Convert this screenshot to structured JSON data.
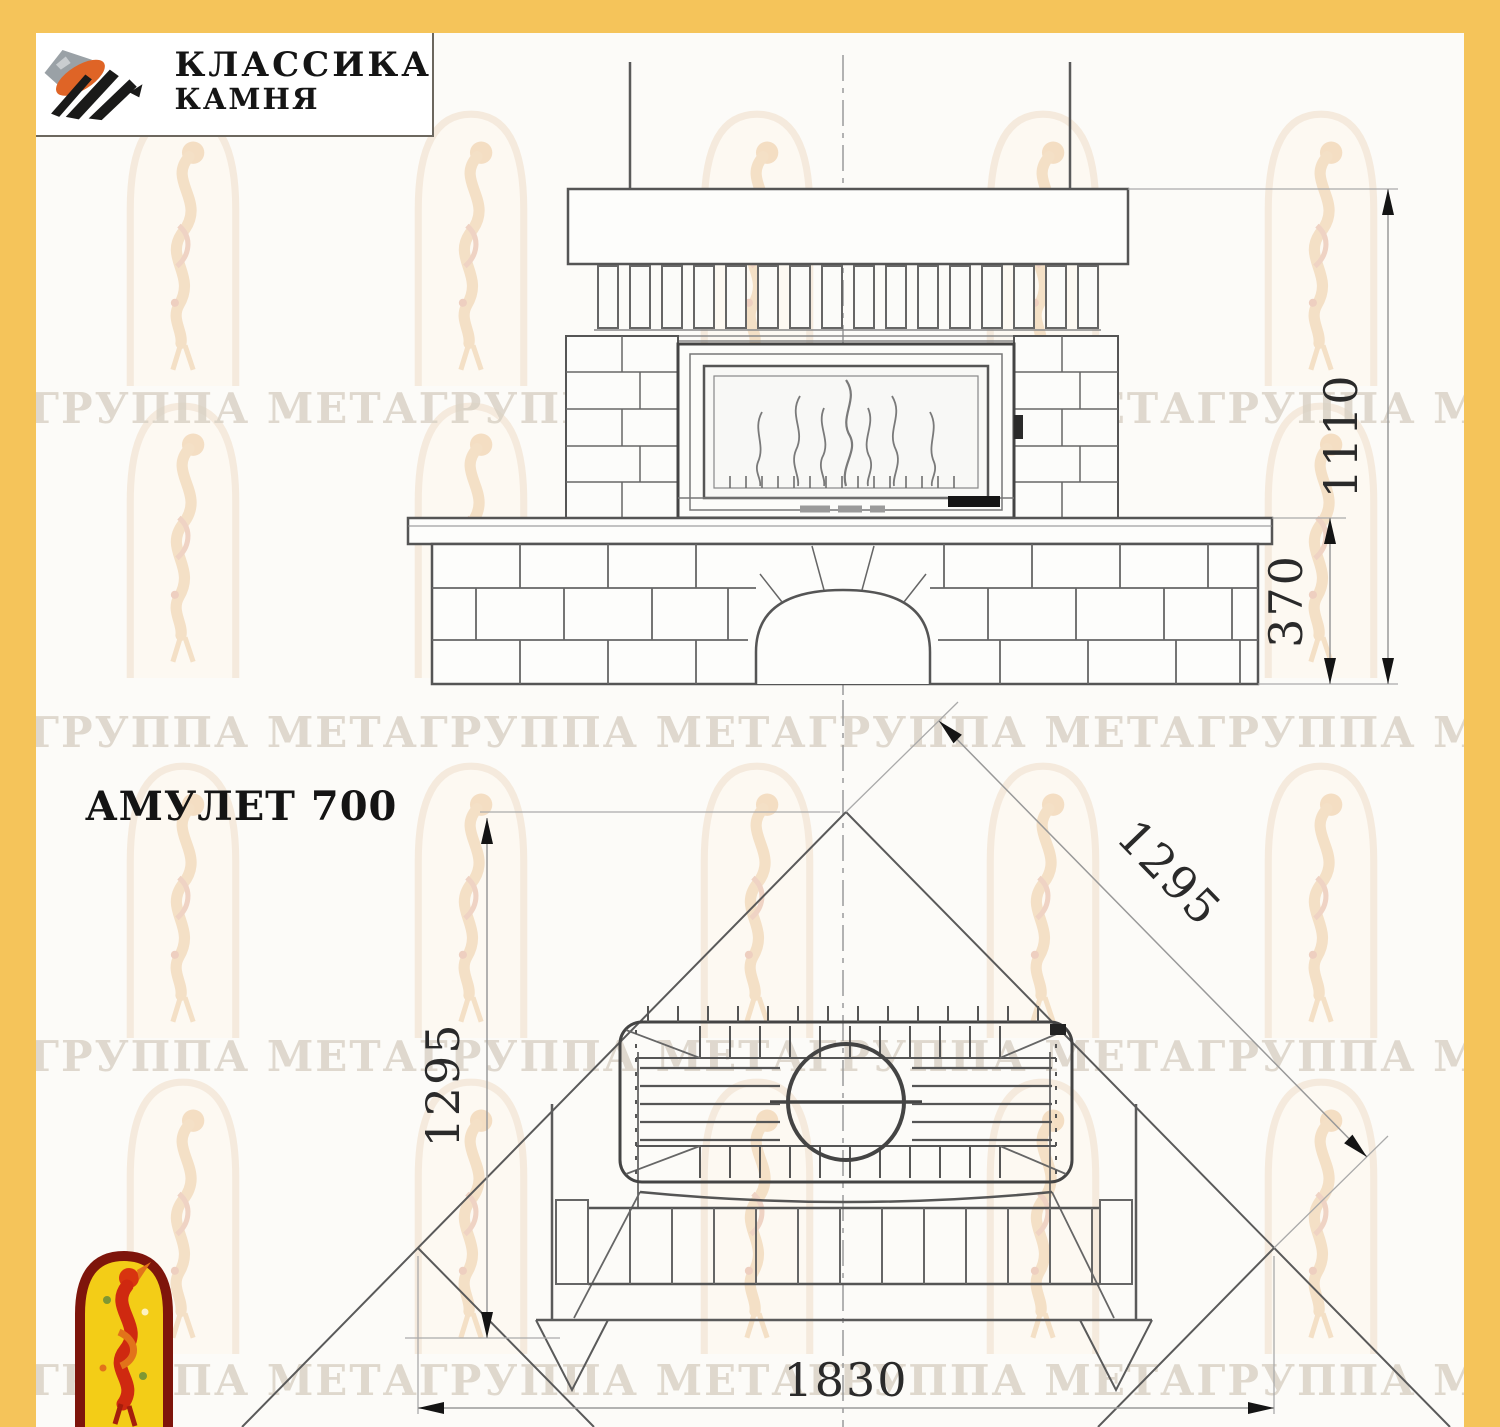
{
  "page": {
    "bg": "#fcfbf8",
    "accent_yellow": "#f5c45a"
  },
  "logo": {
    "line1": "КЛАССИКА",
    "line2": "КАМНЯ"
  },
  "title": "АМУЛЕТ 700",
  "watermark": {
    "text": "ГРУППА МЕТАГРУППА МЕТАГРУППА МЕТАГРУППА МЕТА"
  },
  "front_view": {
    "dim_height": "1110",
    "dim_plinth": "370"
  },
  "plan_view": {
    "dim_side_left": "1295",
    "dim_side_diag": "1295",
    "dim_front": "1830"
  },
  "colors": {
    "emblem_red": "#cf2910",
    "emblem_yellow": "#f3cd17",
    "stone_orange": "#df6426"
  }
}
